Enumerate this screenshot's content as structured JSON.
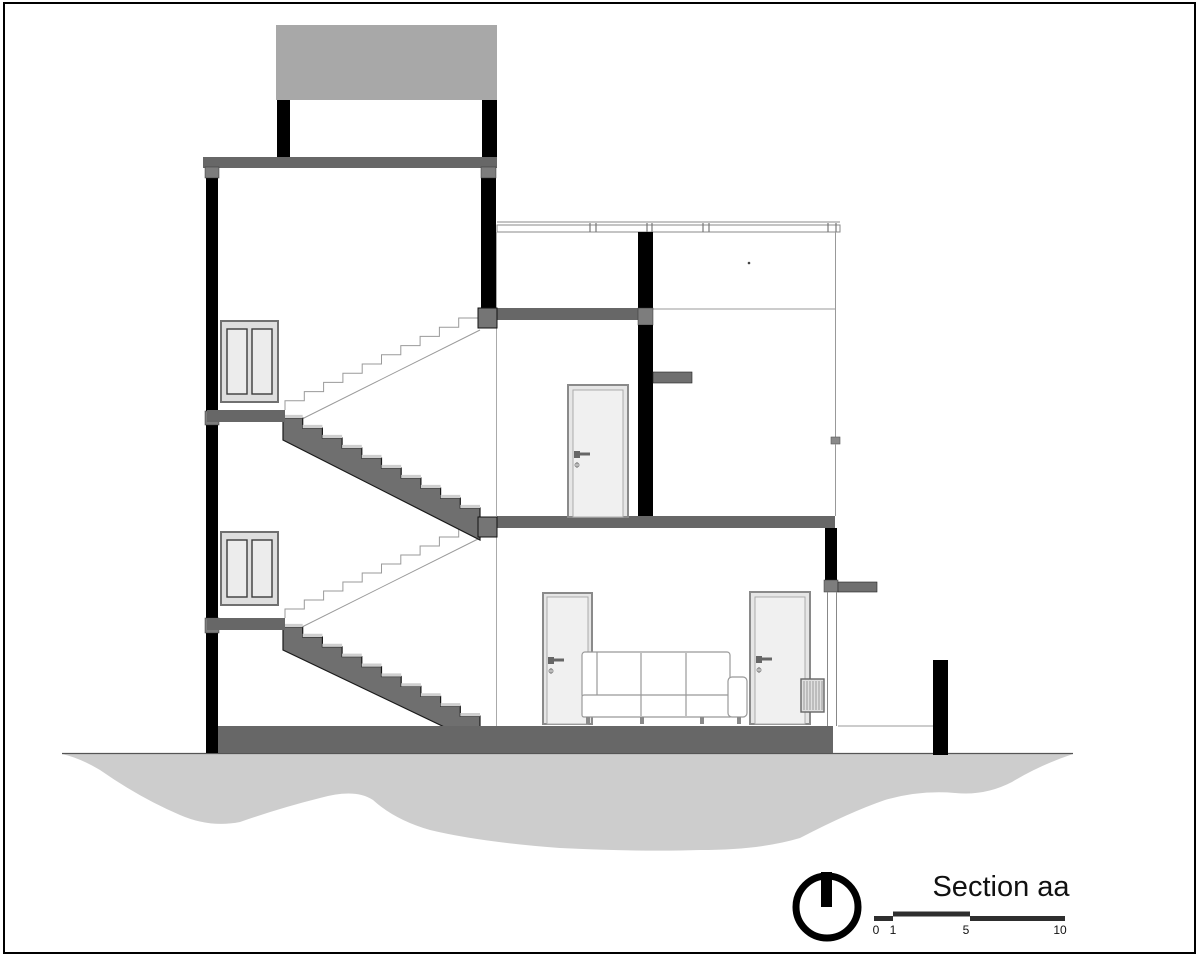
{
  "drawing": {
    "type": "architectural-section",
    "title": "Section aa",
    "scale_bar": {
      "labels": [
        "0",
        "1",
        "5",
        "10"
      ]
    },
    "symbols": {
      "north_indicator": "circle-with-vertical-bar"
    },
    "colors": {
      "cut_wall_black": "#000000",
      "slab_gray": "#676767",
      "stair_fill_gray": "#6f6f6f",
      "junction_block_gray": "#7d7d7d",
      "parapet_gray": "#a8a8a8",
      "ground_gray": "#cdcdcd",
      "tread_cap_gray": "#cfcfcf",
      "door_leaf": "#f0f0f0",
      "window_pane": "#ececec",
      "outline_light": "#9a9a9a"
    }
  }
}
